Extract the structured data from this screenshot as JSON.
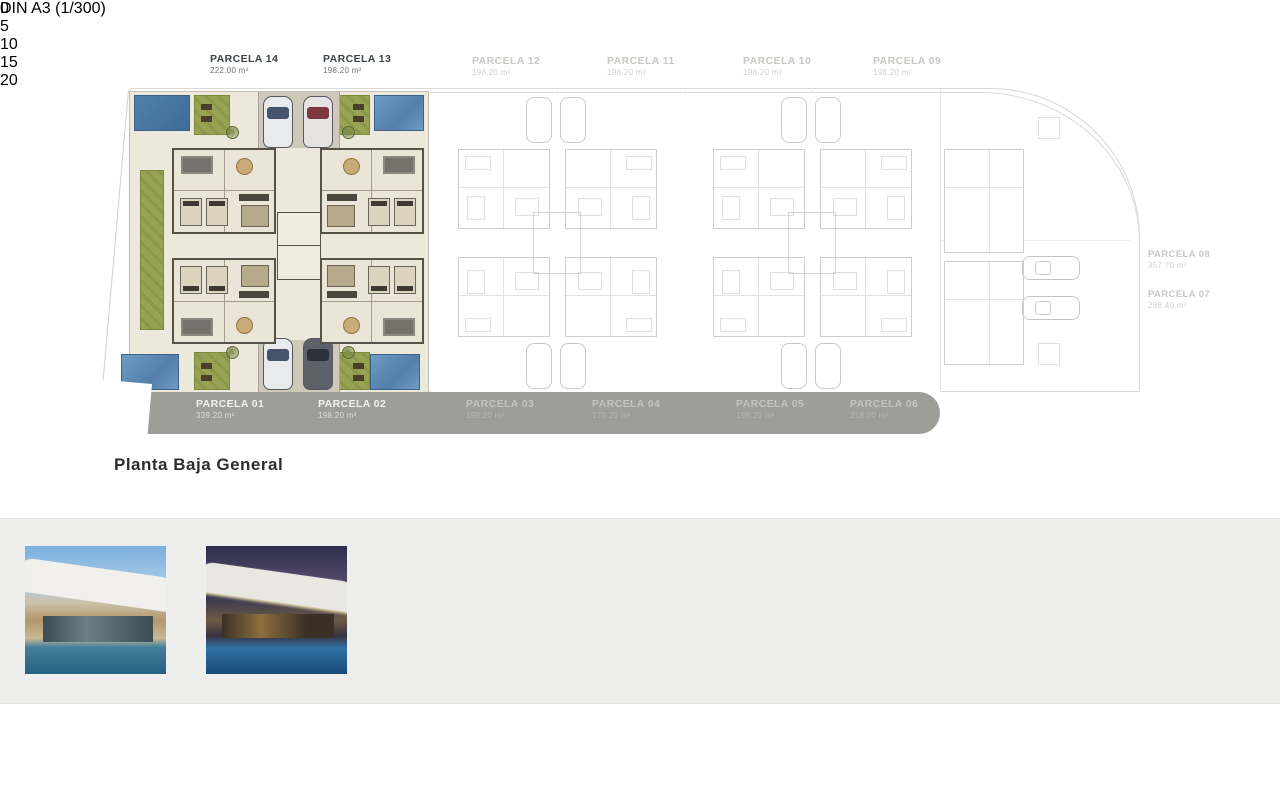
{
  "plan": {
    "title": "Planta Baja General",
    "top_labels": [
      {
        "name": "PARCELA 14",
        "area": "222.00 m²"
      },
      {
        "name": "PARCELA 13",
        "area": "198.20 m²"
      },
      {
        "name": "PARCELA 12",
        "area": "198.20 m²"
      },
      {
        "name": "PARCELA 11",
        "area": "198.20 m²"
      },
      {
        "name": "PARCELA 10",
        "area": "198.20 m²"
      },
      {
        "name": "PARCELA 09",
        "area": "198.20 m²"
      }
    ],
    "right_labels": [
      {
        "name": "PARCELA 08",
        "area": "357.70 m²"
      },
      {
        "name": "PARCELA 07",
        "area": "268.40 m²"
      }
    ],
    "band_labels": [
      {
        "name": "PARCELA 01",
        "area": "339.20 m²"
      },
      {
        "name": "PARCELA 02",
        "area": "198.20 m²"
      },
      {
        "name": "PARCELA 03",
        "area": "198.20 m²"
      },
      {
        "name": "PARCELA 04",
        "area": "179.20 m²"
      },
      {
        "name": "PARCELA 05",
        "area": "198.20 m²"
      },
      {
        "name": "PARCELA 06",
        "area": "218.00 m²"
      }
    ]
  },
  "gallery": {
    "photos": [
      {
        "name": "exterior-villa-day"
      },
      {
        "name": "exterior-villa-dusk"
      },
      {
        "name": "interior-living-terrace"
      },
      {
        "name": "interior-living-sofa"
      },
      {
        "name": "interior-kitchen-dining"
      },
      {
        "name": "interior-bedroom"
      },
      {
        "name": "interior-bathroom"
      }
    ]
  },
  "footer": {
    "sheet_label": "DIN A3 (1/300)",
    "scale_ticks": [
      "0",
      "5",
      "10",
      "15",
      "20"
    ]
  },
  "colors": {
    "pool_blue": "#5e8db8",
    "garden_green": "#95a050",
    "road_gray": "#9e9e99",
    "floor_cream": "#ece8dc",
    "photo_band": "#eeeeec"
  }
}
